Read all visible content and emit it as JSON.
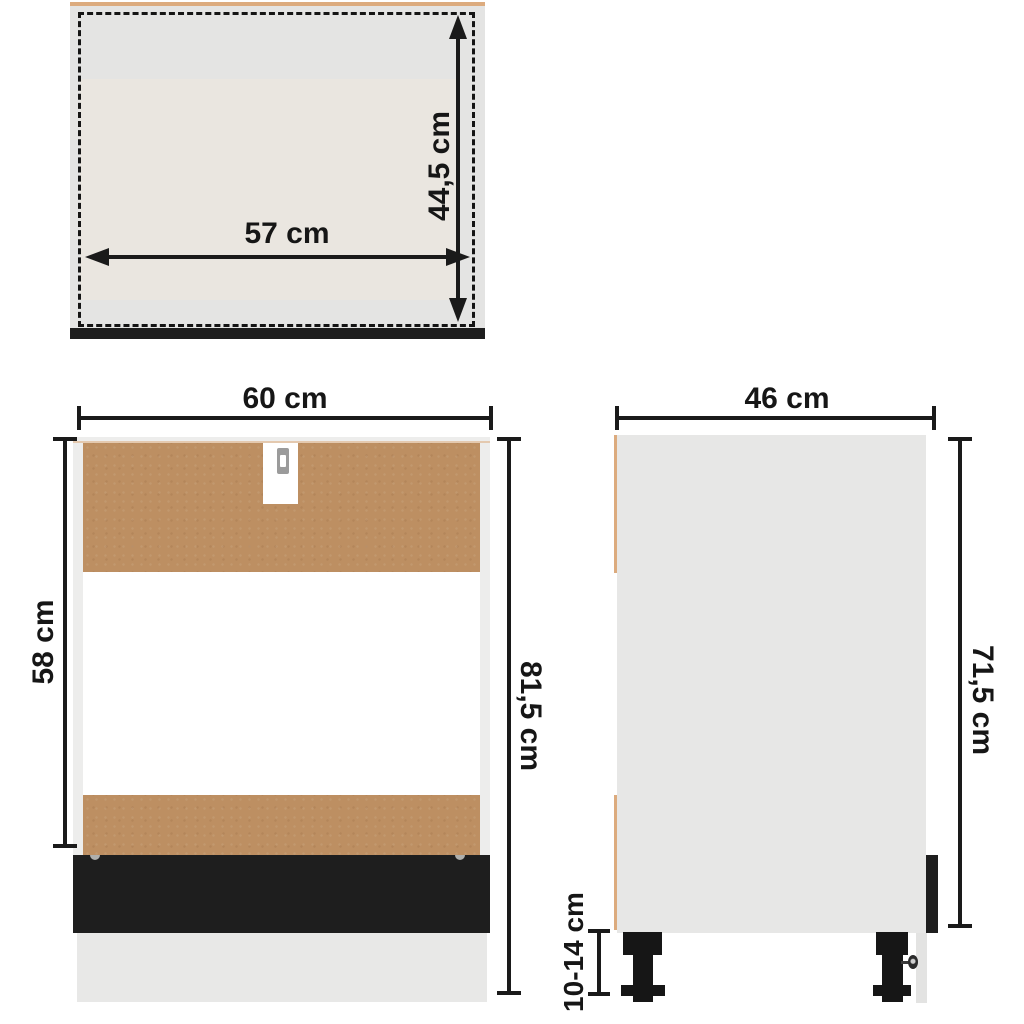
{
  "diagram": {
    "views": {
      "top": {
        "dimensions": {
          "inner_width": {
            "label": "57 cm"
          },
          "inner_depth": {
            "label": "44,5 cm"
          }
        }
      },
      "front": {
        "dimensions": {
          "width": {
            "label": "60 cm"
          },
          "opening_height": {
            "label": "58 cm"
          },
          "total_height": {
            "label": "81,5 cm"
          }
        }
      },
      "side": {
        "dimensions": {
          "depth": {
            "label": "46 cm"
          },
          "body_height": {
            "label": "71,5 cm"
          },
          "leg_height": {
            "label": "10-14 cm"
          }
        }
      }
    }
  },
  "colors": {
    "line": "#1a1a1a",
    "panel_gray": "#e4e4e3",
    "panel_gray_side": "#e7e7e6",
    "inner_beige": "#eae6e0",
    "particle_brown": "#bd8f62",
    "edge_tan": "#dcab7e",
    "plinth_black": "#1e1e1e",
    "frame_white": "#ededec",
    "slot_gray": "#9b9b9b",
    "plinth_gray": "#e8e8e7",
    "leg_black": "#161616"
  }
}
